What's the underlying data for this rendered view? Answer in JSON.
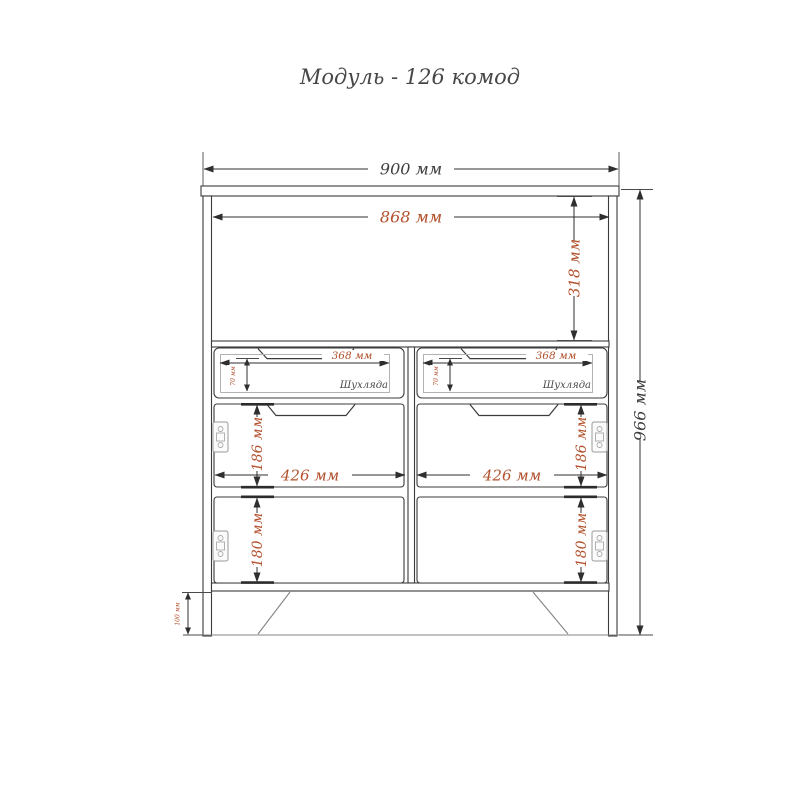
{
  "title": "Модуль - 126 комод",
  "colors": {
    "accent_text": "#b2502c",
    "dark_text": "#3f3f3f",
    "line": "#3b3b3b",
    "hardware": "#9a9a9a"
  },
  "dims": {
    "width_overall": "900 мм",
    "width_inner": "868 мм",
    "height_overall": "966 мм",
    "open_section_height": "318 мм",
    "drawer_left_width": "368 мм",
    "drawer_right_width": "368 мм",
    "drawer_left_front_height": "70 мм",
    "drawer_right_front_height": "70 мм",
    "door_upper_left_height": "186 мм",
    "door_upper_right_height": "186 мм",
    "door_lower_left_height": "180 мм",
    "door_lower_right_height": "180 мм",
    "door_left_width": "426 мм",
    "door_right_width": "426 мм",
    "plinth_height": "100 мм"
  },
  "labels": {
    "drawer_left": "Шухляда",
    "drawer_right": "Шухляда"
  }
}
